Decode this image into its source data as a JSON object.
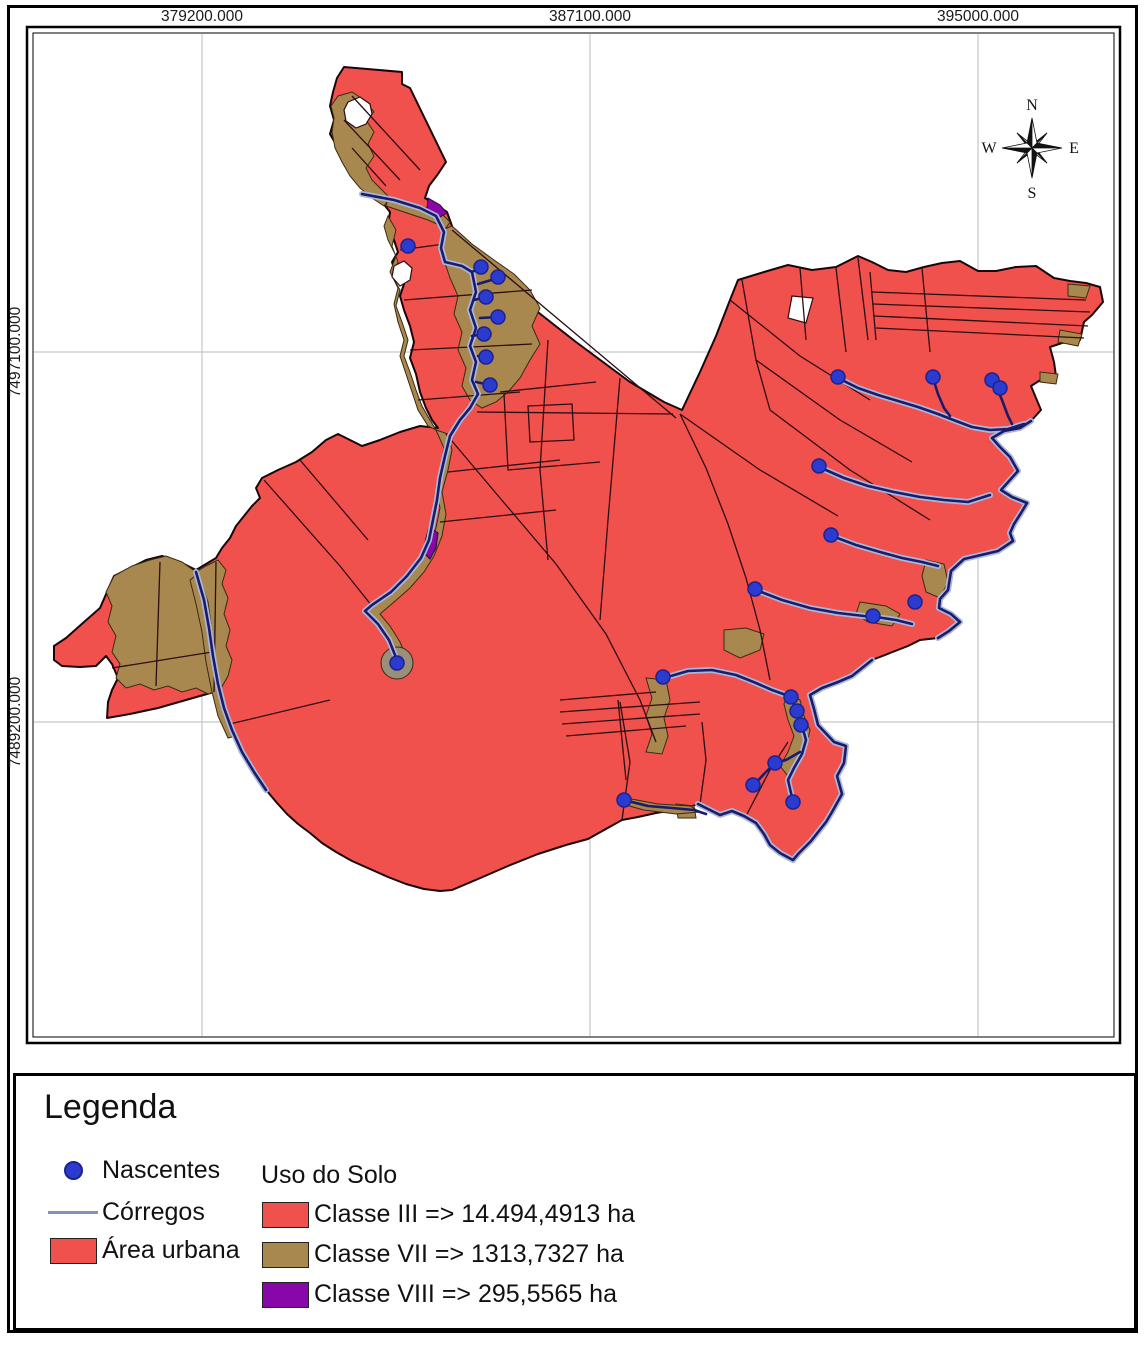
{
  "grid": {
    "top_labels": [
      {
        "text": "379200.000"
      },
      {
        "text": "387100.000"
      },
      {
        "text": "395000.000"
      }
    ],
    "left_labels": [
      {
        "text": "7497100.000"
      },
      {
        "text": "7489200.000"
      }
    ]
  },
  "compass": {
    "n": "N",
    "e": "E",
    "s": "S",
    "w": "W"
  },
  "legend": {
    "title": "Legenda",
    "symbols": [
      {
        "name": "nascentes",
        "label": "Nascentes"
      },
      {
        "name": "corregos",
        "label": "Córregos"
      },
      {
        "name": "area_urbana",
        "label": "Área urbana"
      }
    ],
    "uso_do_solo": {
      "title": "Uso do Solo",
      "items": [
        {
          "label": "Classe III => 14.494,4913 ha",
          "color": "#f1514c"
        },
        {
          "label": "Classe VII => 1313,7327 ha",
          "color": "#a9884f"
        },
        {
          "label": "Classe VIII => 295,5565 ha",
          "color": "#8707a8"
        }
      ]
    }
  },
  "colors": {
    "classe_iii": "#f1514c",
    "classe_vii": "#a9884f",
    "classe_viii": "#8707a8",
    "stream": "#1c1a6b",
    "stream_halo": "#a9b8d9",
    "spring_dot": "#2b3bd0",
    "spring_ring": "#1b2290",
    "parcel_line": "#2d0d12",
    "boundary": "#1a060a",
    "gridline": "#c6c6c6",
    "corregos_symbol": "#8193b6"
  },
  "map": {
    "springs": [
      [
        408,
        246
      ],
      [
        481,
        267
      ],
      [
        498,
        277
      ],
      [
        486,
        297
      ],
      [
        498,
        317
      ],
      [
        484,
        334
      ],
      [
        486,
        357
      ],
      [
        490,
        385
      ],
      [
        397,
        663
      ],
      [
        838,
        377
      ],
      [
        933,
        377
      ],
      [
        992,
        380
      ],
      [
        1000,
        388
      ],
      [
        819,
        466
      ],
      [
        831,
        535
      ],
      [
        755,
        589
      ],
      [
        873,
        616
      ],
      [
        915,
        602
      ],
      [
        663,
        677
      ],
      [
        791,
        697
      ],
      [
        797,
        711
      ],
      [
        801,
        725
      ],
      [
        775,
        763
      ],
      [
        753,
        785
      ],
      [
        793,
        802
      ],
      [
        624,
        800
      ]
    ]
  }
}
